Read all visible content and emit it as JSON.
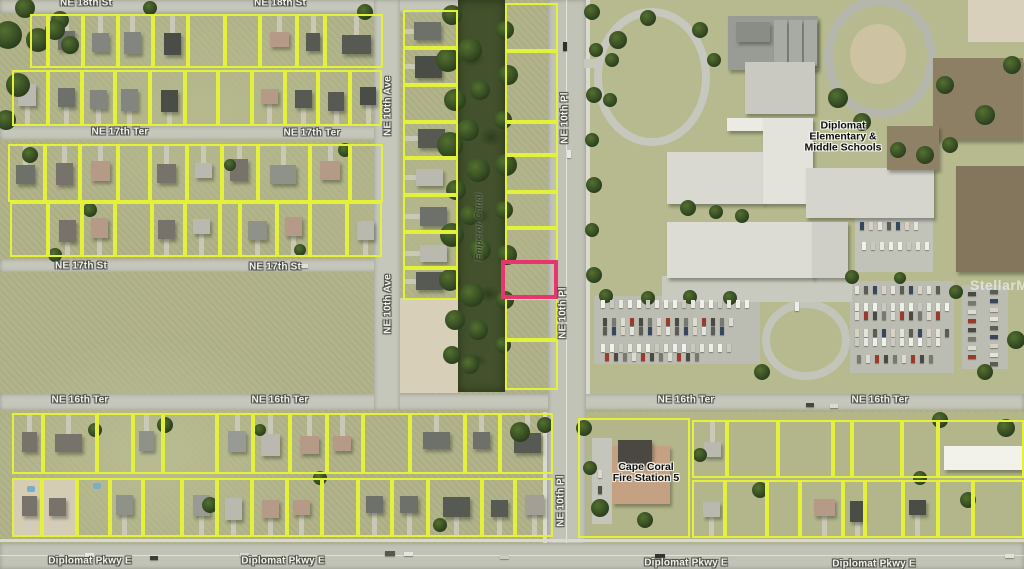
{
  "map": {
    "watermark_text": "StellarMLS",
    "colors": {
      "parcel_outline": "#e4f13b",
      "highlight_outline": "#e8356b",
      "road": "#c6c7bb",
      "road_major": "#c2c3b7",
      "canal_water": "#43522c",
      "grass": "#afb187",
      "campus_grass": "#b6ba8e",
      "sand": "#d7cfb8",
      "tree": "#3b5226",
      "lot_pavement": "#bcbdb2"
    },
    "street_labels": [
      {
        "t": "NE 18th St",
        "x": 86,
        "y": 3
      },
      {
        "t": "NE 18th St",
        "x": 280,
        "y": 3
      },
      {
        "t": "NE 17th Ter",
        "x": 120,
        "y": 132
      },
      {
        "t": "NE 17th Ter",
        "x": 312,
        "y": 133
      },
      {
        "t": "NE 17th St",
        "x": 81,
        "y": 266
      },
      {
        "t": "NE 17th St",
        "x": 275,
        "y": 267
      },
      {
        "t": "NE 16th Ter",
        "x": 80,
        "y": 400
      },
      {
        "t": "NE 16th Ter",
        "x": 280,
        "y": 400
      },
      {
        "t": "NE 16th Ter",
        "x": 686,
        "y": 400
      },
      {
        "t": "NE 16th Ter",
        "x": 880,
        "y": 400
      },
      {
        "t": "Diplomat Pkwy E",
        "x": 90,
        "y": 561
      },
      {
        "t": "Diplomat Pkwy E",
        "x": 283,
        "y": 561
      },
      {
        "t": "Diplomat Pkwy E",
        "x": 686,
        "y": 563
      },
      {
        "t": "Diplomat Pkwy E",
        "x": 874,
        "y": 564
      },
      {
        "t": "NE 10th Ave",
        "x": 388,
        "y": 106,
        "rot": true
      },
      {
        "t": "NE 10th Ave",
        "x": 388,
        "y": 304,
        "rot": true
      },
      {
        "t": "NE 10th Pl",
        "x": 565,
        "y": 118,
        "rot": true
      },
      {
        "t": "NE 10th Pl",
        "x": 563,
        "y": 313,
        "rot": true
      },
      {
        "t": "NE 10th Pl",
        "x": 561,
        "y": 501,
        "rot": true
      }
    ],
    "poi": {
      "school_lines": [
        "Diplomat",
        "Elementary &",
        "Middle Schools"
      ],
      "school_pos": {
        "x": 843,
        "y": 137
      },
      "fire_lines": [
        "Cape Coral",
        "Fire Station 5"
      ],
      "fire_pos": {
        "x": 646,
        "y": 473
      },
      "canal_name": "Emperor Canal",
      "canal_pos": {
        "x": 479,
        "y": 227
      }
    },
    "highlight_parcel": {
      "x": 501,
      "y": 260,
      "w": 57,
      "h": 39
    },
    "roads": [
      {
        "x": 0,
        "y": 0,
        "w": 462,
        "h": 13
      },
      {
        "x": 0,
        "y": 126,
        "w": 400,
        "h": 14
      },
      {
        "x": 0,
        "y": 259,
        "w": 400,
        "h": 13
      },
      {
        "x": 0,
        "y": 394,
        "w": 1024,
        "h": 16
      },
      {
        "x": 374,
        "y": 0,
        "w": 26,
        "h": 410
      },
      {
        "x": 548,
        "y": 0,
        "w": 38,
        "h": 569,
        "major": true
      },
      {
        "x": 0,
        "y": 543,
        "w": 1024,
        "h": 26,
        "major": true
      }
    ],
    "sidewalks": [
      {
        "x": 586,
        "y": 0,
        "w": 4,
        "h": 394
      },
      {
        "x": 543,
        "y": 412,
        "w": 4,
        "h": 131
      },
      {
        "x": 0,
        "y": 539,
        "w": 1024,
        "h": 3
      }
    ],
    "canal": {
      "x": 458,
      "y": 0,
      "w": 47,
      "h": 392
    },
    "terrain": [
      {
        "x": 585,
        "y": 0,
        "w": 439,
        "h": 394,
        "c": "#b6ba8e"
      },
      {
        "x": 400,
        "y": 298,
        "w": 58,
        "h": 95,
        "c": "#d7cfb8"
      },
      {
        "x": 968,
        "y": 0,
        "w": 56,
        "h": 42,
        "c": "#d8d0ba"
      },
      {
        "x": 12,
        "y": 480,
        "w": 65,
        "h": 57,
        "c": "#d5ccb4"
      },
      {
        "x": 586,
        "y": 412,
        "w": 438,
        "h": 131,
        "c": "#b3b68b"
      }
    ],
    "track": {
      "x": 824,
      "y": -4,
      "w": 112,
      "h": 122,
      "ring": "#b5b7ac",
      "dirt": {
        "x": 850,
        "y": 24,
        "w": 56,
        "h": 60,
        "c": "#cdc3a2"
      }
    },
    "bus_loop": {
      "x": 594,
      "y": 8,
      "w": 116,
      "h": 138,
      "ring": "#c6c7bd"
    },
    "loop_stub": {
      "x": 584,
      "y": 59,
      "w": 16,
      "h": 9,
      "c": "#c6c7bd"
    },
    "drive_loop": {
      "x": 762,
      "y": 300,
      "w": 88,
      "h": 80,
      "ring": "#c4c5ba"
    },
    "pavements": [
      {
        "x": 594,
        "y": 296,
        "w": 166,
        "h": 68,
        "c": "#bcbdb2"
      },
      {
        "x": 850,
        "y": 281,
        "w": 104,
        "h": 92,
        "c": "#bcbdb2"
      },
      {
        "x": 962,
        "y": 285,
        "w": 46,
        "h": 84,
        "c": "#bcbdb2"
      },
      {
        "x": 855,
        "y": 212,
        "w": 78,
        "h": 60,
        "c": "#c2c3b8"
      },
      {
        "x": 662,
        "y": 276,
        "w": 190,
        "h": 26,
        "c": "#c9cabf"
      },
      {
        "x": 592,
        "y": 438,
        "w": 20,
        "h": 86,
        "c": "#c5c6bb"
      }
    ],
    "buildings": [
      {
        "x": 728,
        "y": 16,
        "w": 90,
        "h": 54,
        "c": "#999c94"
      },
      {
        "x": 736,
        "y": 22,
        "w": 34,
        "h": 20,
        "c": "#8a8d85"
      },
      {
        "x": 774,
        "y": 20,
        "w": 13,
        "h": 46,
        "c": "#a8aba3"
      },
      {
        "x": 789,
        "y": 20,
        "w": 13,
        "h": 46,
        "c": "#a8aba3"
      },
      {
        "x": 804,
        "y": 20,
        "w": 13,
        "h": 46,
        "c": "#a8aba3"
      },
      {
        "x": 745,
        "y": 62,
        "w": 70,
        "h": 52,
        "c": "#c9c9c1"
      },
      {
        "x": 727,
        "y": 118,
        "w": 82,
        "h": 13,
        "c": "#ebebe4"
      },
      {
        "x": 667,
        "y": 152,
        "w": 97,
        "h": 52,
        "c": "#d9d9d2"
      },
      {
        "x": 763,
        "y": 118,
        "w": 50,
        "h": 86,
        "c": "#e3e3dc"
      },
      {
        "x": 806,
        "y": 168,
        "w": 128,
        "h": 50,
        "c": "#d5d5ce"
      },
      {
        "x": 667,
        "y": 222,
        "w": 147,
        "h": 56,
        "c": "#dcdcd5"
      },
      {
        "x": 812,
        "y": 222,
        "w": 36,
        "h": 56,
        "c": "#cfcfc8"
      },
      {
        "x": 933,
        "y": 58,
        "w": 90,
        "h": 82,
        "c": "#8d7f63"
      },
      {
        "x": 887,
        "y": 126,
        "w": 52,
        "h": 44,
        "c": "#8f8166"
      },
      {
        "x": 956,
        "y": 166,
        "w": 68,
        "h": 106,
        "c": "#84765c"
      },
      {
        "x": 944,
        "y": 446,
        "w": 80,
        "h": 24,
        "c": "#f2f2ea"
      },
      {
        "x": 612,
        "y": 446,
        "w": 58,
        "h": 58,
        "c": "#c5a184"
      },
      {
        "x": 618,
        "y": 440,
        "w": 34,
        "h": 26,
        "c": "#4b4741"
      }
    ],
    "fire_parcel": {
      "x": 578,
      "y": 418,
      "w": 112,
      "h": 120
    },
    "blocks": [
      {
        "name": "A1",
        "y": 14,
        "h": 54,
        "bounds": [
          30,
          48,
          83,
          118,
          153,
          188,
          225,
          260,
          297,
          325,
          383
        ],
        "houses": 0.9,
        "dir": "up"
      },
      {
        "name": "A2",
        "y": 70,
        "h": 56,
        "bounds": [
          12,
          48,
          82,
          115,
          150,
          185,
          218,
          252,
          285,
          318,
          350,
          382
        ],
        "houses": 0.9,
        "dir": "down"
      },
      {
        "name": "B1",
        "y": 144,
        "h": 58,
        "bounds": [
          8,
          45,
          80,
          118,
          150,
          187,
          222,
          258,
          310,
          350,
          383
        ],
        "houses": 0.85,
        "dir": "up"
      },
      {
        "name": "B2",
        "y": 202,
        "h": 55,
        "bounds": [
          10,
          48,
          82,
          115,
          152,
          185,
          220,
          240,
          277,
          310,
          347,
          382
        ],
        "houses": 0.8,
        "dir": "down"
      },
      {
        "name": "C1",
        "y": 413,
        "h": 61,
        "bounds": [
          12,
          43,
          97,
          133,
          163,
          217,
          253,
          290,
          327,
          363,
          410,
          465,
          500,
          553
        ],
        "houses": 0.75,
        "dir": "up"
      },
      {
        "name": "C2",
        "y": 478,
        "h": 59,
        "bounds": [
          12,
          42,
          77,
          110,
          143,
          182,
          217,
          252,
          287,
          322,
          358,
          392,
          428,
          482,
          515,
          553
        ],
        "houses": 0.7,
        "dir": "down"
      },
      {
        "name": "D",
        "x": 403,
        "w": 55,
        "vertical": true,
        "bounds": [
          10,
          48,
          85,
          122,
          158,
          195,
          232,
          268,
          300
        ],
        "houses": 0.85,
        "dir": "left"
      },
      {
        "name": "E",
        "x": 505,
        "w": 53,
        "vertical": true,
        "bounds": [
          3,
          51,
          122,
          155,
          192,
          228,
          262,
          298,
          340,
          390
        ],
        "houses": 0,
        "skip": [
          6
        ]
      },
      {
        "name": "F1",
        "y": 420,
        "h": 58,
        "bounds": [
          692,
          727,
          778,
          833,
          852,
          902,
          938,
          1024
        ],
        "houses": 0.35,
        "dir": "up"
      },
      {
        "name": "F2",
        "y": 480,
        "h": 58,
        "bounds": [
          692,
          725,
          767,
          800,
          843,
          865,
          903,
          938,
          973,
          1024
        ],
        "houses": 0.6,
        "dir": "down"
      }
    ],
    "trees": [
      [
        8,
        35,
        14
      ],
      [
        18,
        85,
        12
      ],
      [
        6,
        120,
        10
      ],
      [
        25,
        8,
        10
      ],
      [
        60,
        20,
        9
      ],
      [
        38,
        40,
        12
      ],
      [
        55,
        30,
        10
      ],
      [
        70,
        45,
        9
      ],
      [
        150,
        8,
        7
      ],
      [
        365,
        12,
        8
      ],
      [
        452,
        15,
        10
      ],
      [
        448,
        60,
        12
      ],
      [
        455,
        100,
        11
      ],
      [
        450,
        145,
        13
      ],
      [
        456,
        190,
        10
      ],
      [
        452,
        235,
        12
      ],
      [
        450,
        280,
        11
      ],
      [
        455,
        320,
        10
      ],
      [
        452,
        355,
        9
      ],
      [
        505,
        30,
        9
      ],
      [
        508,
        75,
        10
      ],
      [
        503,
        120,
        9
      ],
      [
        506,
        165,
        11
      ],
      [
        504,
        210,
        9
      ],
      [
        507,
        255,
        10
      ],
      [
        505,
        300,
        9
      ],
      [
        503,
        345,
        8
      ],
      [
        470,
        50,
        12
      ],
      [
        480,
        90,
        10
      ],
      [
        468,
        130,
        11
      ],
      [
        478,
        170,
        12
      ],
      [
        470,
        215,
        10
      ],
      [
        480,
        250,
        11
      ],
      [
        472,
        295,
        12
      ],
      [
        478,
        330,
        10
      ],
      [
        470,
        365,
        9
      ],
      [
        592,
        12,
        8
      ],
      [
        596,
        50,
        7
      ],
      [
        594,
        95,
        8
      ],
      [
        592,
        140,
        7
      ],
      [
        594,
        185,
        8
      ],
      [
        592,
        230,
        7
      ],
      [
        594,
        275,
        8
      ],
      [
        618,
        40,
        9
      ],
      [
        648,
        18,
        8
      ],
      [
        700,
        30,
        8
      ],
      [
        714,
        60,
        7
      ],
      [
        838,
        98,
        10
      ],
      [
        862,
        122,
        9
      ],
      [
        898,
        150,
        8
      ],
      [
        925,
        155,
        9
      ],
      [
        688,
        208,
        8
      ],
      [
        716,
        212,
        7
      ],
      [
        742,
        216,
        7
      ],
      [
        945,
        85,
        9
      ],
      [
        985,
        115,
        10
      ],
      [
        1012,
        65,
        9
      ],
      [
        950,
        145,
        8
      ],
      [
        606,
        296,
        7
      ],
      [
        648,
        298,
        7
      ],
      [
        690,
        297,
        7
      ],
      [
        730,
        298,
        7
      ],
      [
        762,
        372,
        8
      ],
      [
        852,
        277,
        7
      ],
      [
        900,
        278,
        6
      ],
      [
        956,
        292,
        7
      ],
      [
        985,
        372,
        8
      ],
      [
        1016,
        340,
        9
      ],
      [
        584,
        428,
        8
      ],
      [
        600,
        508,
        9
      ],
      [
        645,
        520,
        8
      ],
      [
        590,
        468,
        7
      ],
      [
        700,
        455,
        7
      ],
      [
        760,
        490,
        8
      ],
      [
        940,
        420,
        8
      ],
      [
        1006,
        428,
        9
      ],
      [
        920,
        478,
        7
      ],
      [
        968,
        500,
        8
      ],
      [
        165,
        425,
        8
      ],
      [
        210,
        505,
        8
      ],
      [
        320,
        478,
        7
      ],
      [
        95,
        430,
        7
      ],
      [
        260,
        430,
        6
      ],
      [
        440,
        525,
        7
      ],
      [
        520,
        432,
        10
      ],
      [
        545,
        425,
        8
      ],
      [
        30,
        155,
        8
      ],
      [
        90,
        210,
        7
      ],
      [
        230,
        165,
        6
      ],
      [
        345,
        150,
        7
      ],
      [
        300,
        250,
        6
      ],
      [
        55,
        255,
        7
      ],
      [
        612,
        60,
        7
      ],
      [
        610,
        100,
        7
      ]
    ],
    "pools": [
      [
        27,
        486
      ],
      [
        93,
        483
      ]
    ],
    "car_rows": [
      {
        "x": 601,
        "y": 300,
        "n": 17,
        "dx": 9
      },
      {
        "x": 603,
        "y": 318,
        "n": 15,
        "dx": 9
      },
      {
        "x": 603,
        "y": 327,
        "n": 14,
        "dx": 9
      },
      {
        "x": 601,
        "y": 344,
        "n": 15,
        "dx": 9
      },
      {
        "x": 605,
        "y": 353,
        "n": 11,
        "dx": 9
      },
      {
        "x": 855,
        "y": 286,
        "n": 10,
        "dx": 9
      },
      {
        "x": 855,
        "y": 303,
        "n": 11,
        "dx": 9
      },
      {
        "x": 855,
        "y": 312,
        "n": 10,
        "dx": 9
      },
      {
        "x": 855,
        "y": 329,
        "n": 11,
        "dx": 9
      },
      {
        "x": 855,
        "y": 338,
        "n": 10,
        "dx": 9
      },
      {
        "x": 857,
        "y": 355,
        "n": 9,
        "dx": 9
      },
      {
        "x": 860,
        "y": 222,
        "n": 7,
        "dx": 9
      },
      {
        "x": 862,
        "y": 242,
        "n": 8,
        "dx": 9
      },
      {
        "x": 968,
        "y": 292,
        "n": 8,
        "dy": 9,
        "horiz": true
      },
      {
        "x": 990,
        "y": 290,
        "n": 9,
        "dy": 9,
        "horiz": true
      }
    ],
    "road_cars": [
      {
        "x": 85,
        "y": 553,
        "w": 9,
        "h": 4,
        "c": "#e8e8e2"
      },
      {
        "x": 150,
        "y": 556,
        "w": 8,
        "h": 4,
        "c": "#3c3c38"
      },
      {
        "x": 240,
        "y": 553,
        "w": 9,
        "h": 4,
        "c": "#d8d8d0"
      },
      {
        "x": 385,
        "y": 551,
        "w": 10,
        "h": 5,
        "c": "#55584f"
      },
      {
        "x": 404,
        "y": 552,
        "w": 9,
        "h": 4,
        "c": "#e5e5df"
      },
      {
        "x": 500,
        "y": 555,
        "w": 9,
        "h": 4,
        "c": "#caccc2"
      },
      {
        "x": 655,
        "y": 554,
        "w": 10,
        "h": 4,
        "c": "#32342f"
      },
      {
        "x": 1005,
        "y": 554,
        "w": 9,
        "h": 4,
        "c": "#e2e2da"
      },
      {
        "x": 563,
        "y": 42,
        "w": 4,
        "h": 9,
        "c": "#2f312c"
      },
      {
        "x": 567,
        "y": 150,
        "w": 4,
        "h": 8,
        "c": "#e8e8e0"
      },
      {
        "x": 562,
        "y": 330,
        "w": 4,
        "h": 8,
        "c": "#d8d8ce"
      },
      {
        "x": 806,
        "y": 403,
        "w": 8,
        "h": 4,
        "c": "#454741"
      },
      {
        "x": 830,
        "y": 404,
        "w": 8,
        "h": 4,
        "c": "#dadad2"
      },
      {
        "x": 300,
        "y": 264,
        "w": 8,
        "h": 4,
        "c": "#e0e0d8"
      },
      {
        "x": 598,
        "y": 470,
        "w": 4,
        "h": 8,
        "c": "#d9d9d1"
      },
      {
        "x": 598,
        "y": 486,
        "w": 4,
        "h": 8,
        "c": "#50524a"
      },
      {
        "x": 795,
        "y": 302,
        "w": 4,
        "h": 9,
        "c": "#eeeee8"
      }
    ],
    "house_palette": [
      "#83867e",
      "#6e7169",
      "#565a52",
      "#989b93",
      "#a49f94",
      "#494d45",
      "#8f9289",
      "#77726a",
      "#b59a88",
      "#b9b9b0"
    ],
    "car_palette": [
      "#f2f2ec",
      "#dcdcd4",
      "#5a5d55",
      "#c9c9c1",
      "#9a3b2e",
      "#37475e",
      "#e8e8e0",
      "#4a4a44",
      "#d9d2c4",
      "#eeeeea",
      "#767972",
      "#e4e4dc"
    ]
  }
}
